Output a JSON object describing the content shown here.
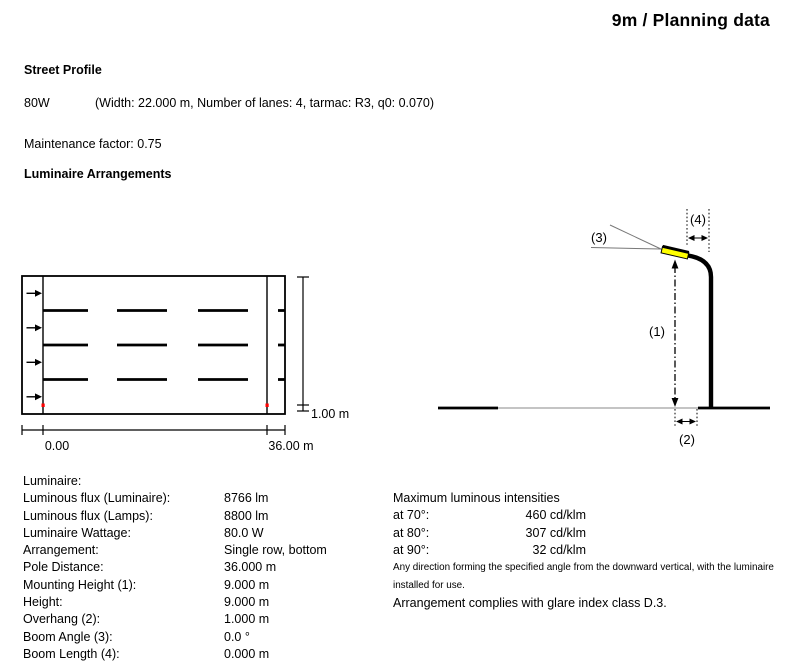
{
  "page": {
    "title": "9m / Planning data"
  },
  "street_profile": {
    "heading": "Street Profile",
    "label": "80W",
    "details": "(Width: 22.000 m, Number of lanes: 4, tarmac: R3, q0: 0.070)",
    "maintenance_factor": "Maintenance factor: 0.75"
  },
  "arrangements": {
    "heading": "Luminaire Arrangements"
  },
  "plan_diagram": {
    "verge_width_label": "1.00 m",
    "origin_label": "0.00",
    "pole_distance_label": "36.00 m",
    "marker_color": "#ff0000"
  },
  "elevation_diagram": {
    "mounting_height_ref": "(1)",
    "overhang_ref": "(2)",
    "boom_angle_ref": "(3)",
    "boom_length_ref": "(4)",
    "luminaire_color": "#ffff00"
  },
  "luminaire_data": {
    "heading": "Luminaire:",
    "rows": [
      {
        "label": "Luminous flux (Luminaire):",
        "value": "8766 lm"
      },
      {
        "label": "Luminous flux (Lamps):",
        "value": "8800 lm"
      },
      {
        "label": "Luminaire Wattage:",
        "value": "80.0 W"
      },
      {
        "label": "Arrangement:",
        "value": "Single row, bottom"
      },
      {
        "label": "Pole Distance:",
        "value": "36.000 m"
      },
      {
        "label": "Mounting Height (1):",
        "value": "9.000 m"
      },
      {
        "label": "Height:",
        "value": "9.000 m"
      },
      {
        "label": "Overhang (2):",
        "value": "1.000 m"
      },
      {
        "label": "Boom Angle (3):",
        "value": "0.0 °"
      },
      {
        "label": "Boom Length (4):",
        "value": "0.000 m"
      }
    ]
  },
  "intensities": {
    "heading": "Maximum luminous intensities",
    "rows": [
      {
        "label": "at 70°:",
        "value": "460 cd/klm"
      },
      {
        "label": "at 80°:",
        "value": "307 cd/klm"
      },
      {
        "label": "at 90°:",
        "value": "32 cd/klm"
      }
    ],
    "footnote": "Any direction forming the specified angle from the downward vertical, with the luminaire installed for use.",
    "compliance": "Arrangement complies with glare index class D.3."
  }
}
